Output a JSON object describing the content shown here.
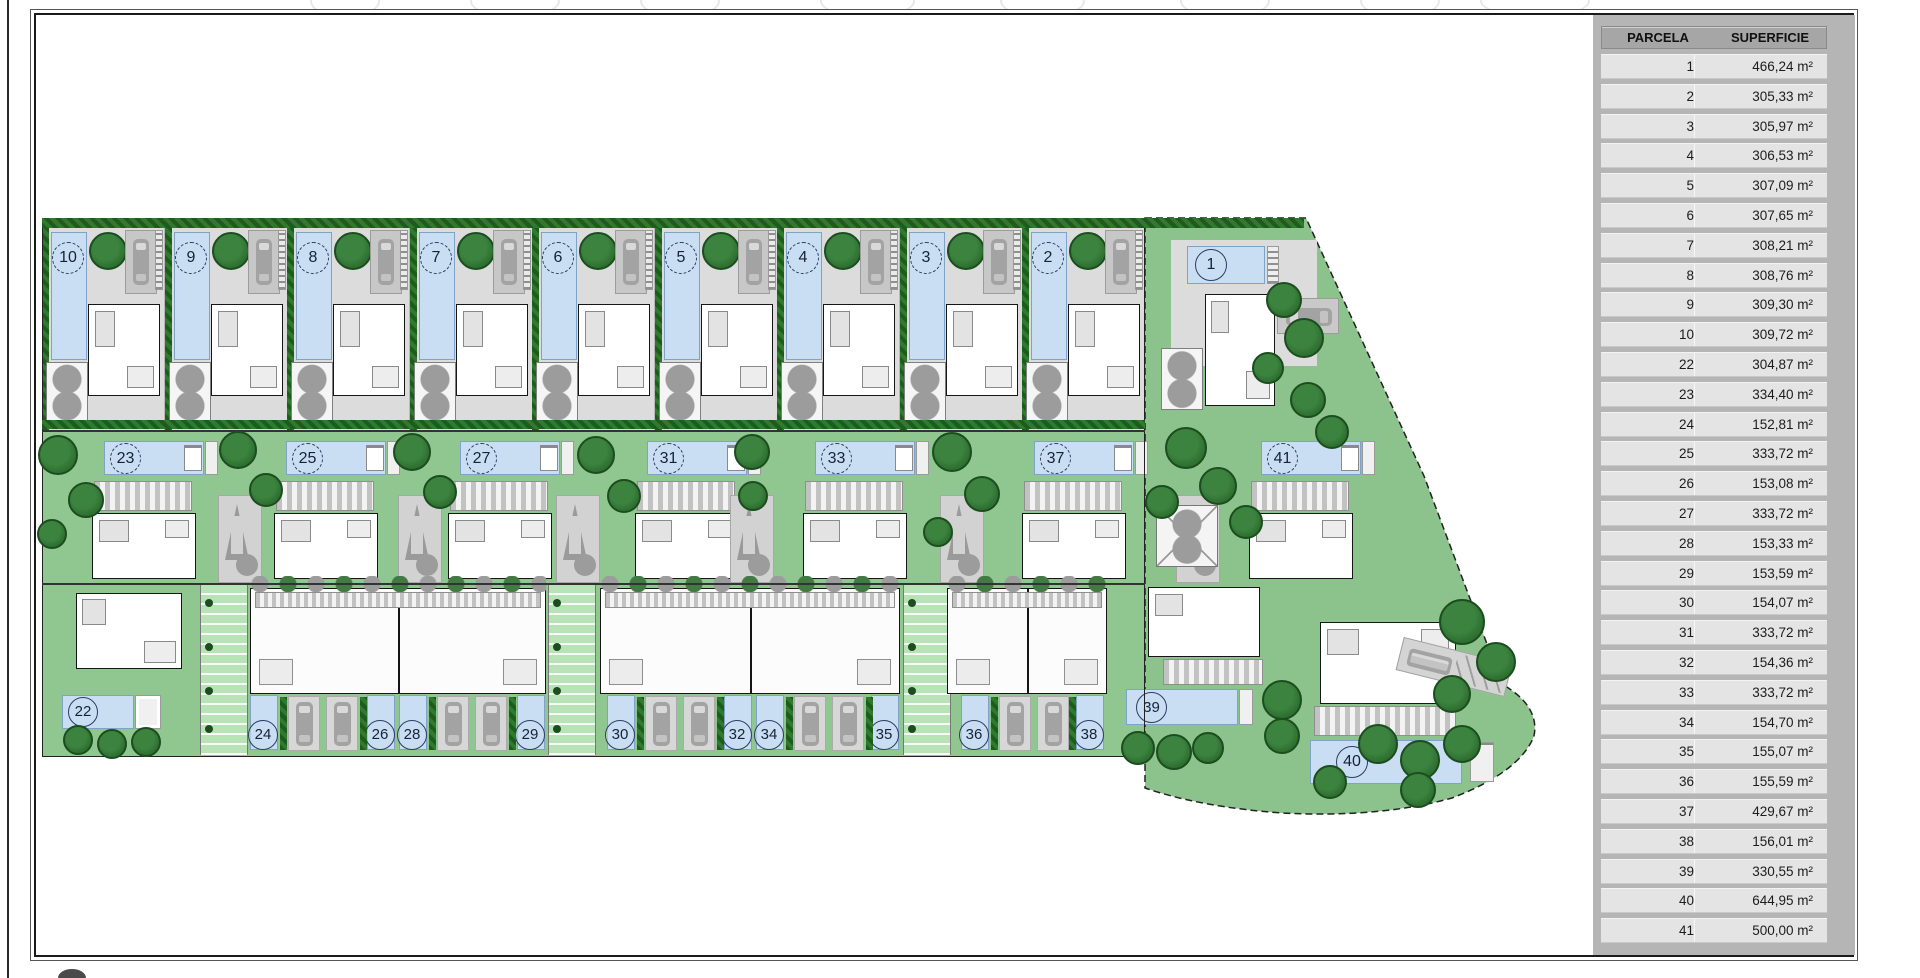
{
  "table": {
    "header": {
      "parcela": "PARCELA",
      "superficie": "SUPERFICIE"
    },
    "rows": [
      {
        "parcela": "1",
        "superficie": "466,24 m²"
      },
      {
        "parcela": "2",
        "superficie": "305,33 m²"
      },
      {
        "parcela": "3",
        "superficie": "305,97 m²"
      },
      {
        "parcela": "4",
        "superficie": "306,53 m²"
      },
      {
        "parcela": "5",
        "superficie": "307,09 m²"
      },
      {
        "parcela": "6",
        "superficie": "307,65 m²"
      },
      {
        "parcela": "7",
        "superficie": "308,21 m²"
      },
      {
        "parcela": "8",
        "superficie": "308,76 m²"
      },
      {
        "parcela": "9",
        "superficie": "309,30 m²"
      },
      {
        "parcela": "10",
        "superficie": "309,72 m²"
      },
      {
        "parcela": "22",
        "superficie": "304,87 m²"
      },
      {
        "parcela": "23",
        "superficie": "334,40 m²"
      },
      {
        "parcela": "24",
        "superficie": "152,81 m²"
      },
      {
        "parcela": "25",
        "superficie": "333,72 m²"
      },
      {
        "parcela": "26",
        "superficie": "153,08 m²"
      },
      {
        "parcela": "27",
        "superficie": "333,72 m²"
      },
      {
        "parcela": "28",
        "superficie": "153,33 m²"
      },
      {
        "parcela": "29",
        "superficie": "153,59 m²"
      },
      {
        "parcela": "30",
        "superficie": "154,07 m²"
      },
      {
        "parcela": "31",
        "superficie": "333,72 m²"
      },
      {
        "parcela": "32",
        "superficie": "154,36 m²"
      },
      {
        "parcela": "33",
        "superficie": "333,72 m²"
      },
      {
        "parcela": "34",
        "superficie": "154,70 m²"
      },
      {
        "parcela": "35",
        "superficie": "155,07 m²"
      },
      {
        "parcela": "36",
        "superficie": "155,59 m²"
      },
      {
        "parcela": "37",
        "superficie": "429,67 m²"
      },
      {
        "parcela": "38",
        "superficie": "156,01 m²"
      },
      {
        "parcela": "39",
        "superficie": "330,55 m²"
      },
      {
        "parcela": "40",
        "superficie": "644,95 m²"
      },
      {
        "parcela": "41",
        "superficie": "500,00 m²"
      }
    ]
  },
  "map": {
    "top_villas": [
      {
        "num": "10",
        "x": 42
      },
      {
        "num": "9",
        "x": 165
      },
      {
        "num": "8",
        "x": 287
      },
      {
        "num": "7",
        "x": 410
      },
      {
        "num": "6",
        "x": 532
      },
      {
        "num": "5",
        "x": 655
      },
      {
        "num": "4",
        "x": 777
      },
      {
        "num": "3",
        "x": 900
      },
      {
        "num": "2",
        "x": 1022
      }
    ],
    "plot1": {
      "num": "1"
    },
    "mid_villas": [
      {
        "num": "23",
        "x": 68
      },
      {
        "num": "25",
        "x": 250
      },
      {
        "num": "27",
        "x": 424
      },
      {
        "num": "31",
        "x": 611
      },
      {
        "num": "33",
        "x": 779
      },
      {
        "num": "37",
        "x": 998
      },
      {
        "num": "41",
        "x": 1225
      }
    ],
    "plot22": {
      "num": "22"
    },
    "plot39": {
      "num": "39"
    },
    "plot40": {
      "num": "40"
    },
    "bottom_pools": [
      {
        "num": "24",
        "x": 250
      },
      {
        "num": "26",
        "x": 367
      },
      {
        "num": "28",
        "x": 399
      },
      {
        "num": "29",
        "x": 517
      },
      {
        "num": "30",
        "x": 607
      },
      {
        "num": "32",
        "x": 724
      },
      {
        "num": "34",
        "x": 756
      },
      {
        "num": "35",
        "x": 871
      },
      {
        "num": "36",
        "x": 961
      },
      {
        "num": "38",
        "x": 1076
      }
    ],
    "cars_x": [
      288,
      326,
      437,
      475,
      645,
      683,
      794,
      832,
      999,
      1037
    ],
    "hedges_x": [
      280,
      360,
      429,
      509,
      637,
      717,
      786,
      866,
      991,
      1069
    ],
    "driveways_x": [
      218,
      398,
      556,
      730,
      940,
      1176
    ],
    "ramps_x": [
      200,
      548,
      903
    ],
    "duplexes": [
      {
        "x": 250,
        "w": 296
      },
      {
        "x": 600,
        "w": 300
      },
      {
        "x": 947,
        "w": 160
      }
    ],
    "trees": [
      [
        58,
        455,
        40
      ],
      [
        86,
        500,
        36
      ],
      [
        52,
        534,
        30
      ],
      [
        238,
        450,
        38
      ],
      [
        266,
        490,
        34
      ],
      [
        412,
        452,
        38
      ],
      [
        440,
        492,
        34
      ],
      [
        596,
        455,
        38
      ],
      [
        624,
        496,
        34
      ],
      [
        752,
        452,
        36
      ],
      [
        753,
        496,
        30
      ],
      [
        952,
        452,
        40
      ],
      [
        982,
        494,
        36
      ],
      [
        938,
        532,
        30
      ],
      [
        1186,
        448,
        42
      ],
      [
        1218,
        486,
        38
      ],
      [
        1162,
        502,
        34
      ],
      [
        1246,
        522,
        34
      ],
      [
        1284,
        300,
        36
      ],
      [
        1304,
        338,
        40
      ],
      [
        1268,
        368,
        32
      ],
      [
        1308,
        400,
        36
      ],
      [
        1332,
        432,
        34
      ],
      [
        1462,
        622,
        46
      ],
      [
        1496,
        662,
        40
      ],
      [
        1452,
        694,
        38
      ],
      [
        1420,
        760,
        40
      ],
      [
        1462,
        744,
        38
      ],
      [
        1378,
        744,
        40
      ],
      [
        1330,
        782,
        34
      ],
      [
        1418,
        790,
        36
      ],
      [
        78,
        740,
        30
      ],
      [
        112,
        744,
        30
      ],
      [
        146,
        742,
        30
      ],
      [
        1138,
        748,
        34
      ],
      [
        1174,
        752,
        36
      ],
      [
        1208,
        748,
        32
      ],
      [
        1282,
        700,
        40
      ],
      [
        1282,
        736,
        36
      ]
    ],
    "watermarks": [
      [
        310,
        70
      ],
      [
        470,
        90
      ],
      [
        640,
        80
      ],
      [
        820,
        95
      ],
      [
        1000,
        85
      ],
      [
        1180,
        90
      ],
      [
        1360,
        80
      ],
      [
        1480,
        110
      ]
    ],
    "colors": {
      "c-pool": "#c9def2",
      "c-pool-br": "#7fa3c6",
      "c-garden": "#90c690",
      "c-garden2": "#8cc38c",
      "c-hedge1": "#1d5c1d",
      "c-hedge2": "#2f7a2f",
      "c-ground": "#dcdcdc",
      "c-tree": "#2e7030",
      "c-tree-br": "#1b4d1e",
      "c-gtree": "#9c9c9c",
      "c-ramp": "#b7e3b7",
      "c-panel": "#b5b5b5",
      "c-rowbg": "#e4e4e4",
      "c-headbg": "#a6a6a6"
    }
  }
}
